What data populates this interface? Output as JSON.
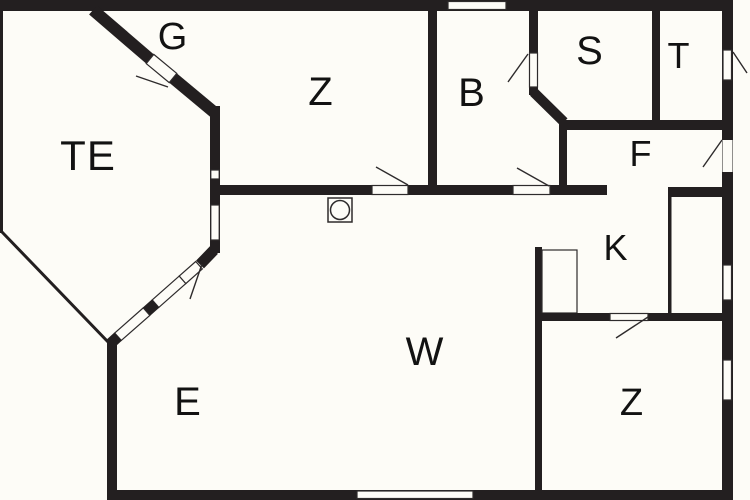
{
  "colors": {
    "wall": "#231f20",
    "line": "#2e2b2c",
    "background": "#fdfcf7"
  },
  "rooms": {
    "te": {
      "label": "TE"
    },
    "g": {
      "label": "G"
    },
    "z_top": {
      "label": "Z"
    },
    "b": {
      "label": "B"
    },
    "s": {
      "label": "S"
    },
    "t": {
      "label": "T"
    },
    "f": {
      "label": "F"
    },
    "k": {
      "label": "K"
    },
    "w": {
      "label": "W"
    },
    "e": {
      "label": "E"
    },
    "z_bottom": {
      "label": "Z"
    }
  },
  "symbols": {
    "stove": "stove-icon"
  }
}
